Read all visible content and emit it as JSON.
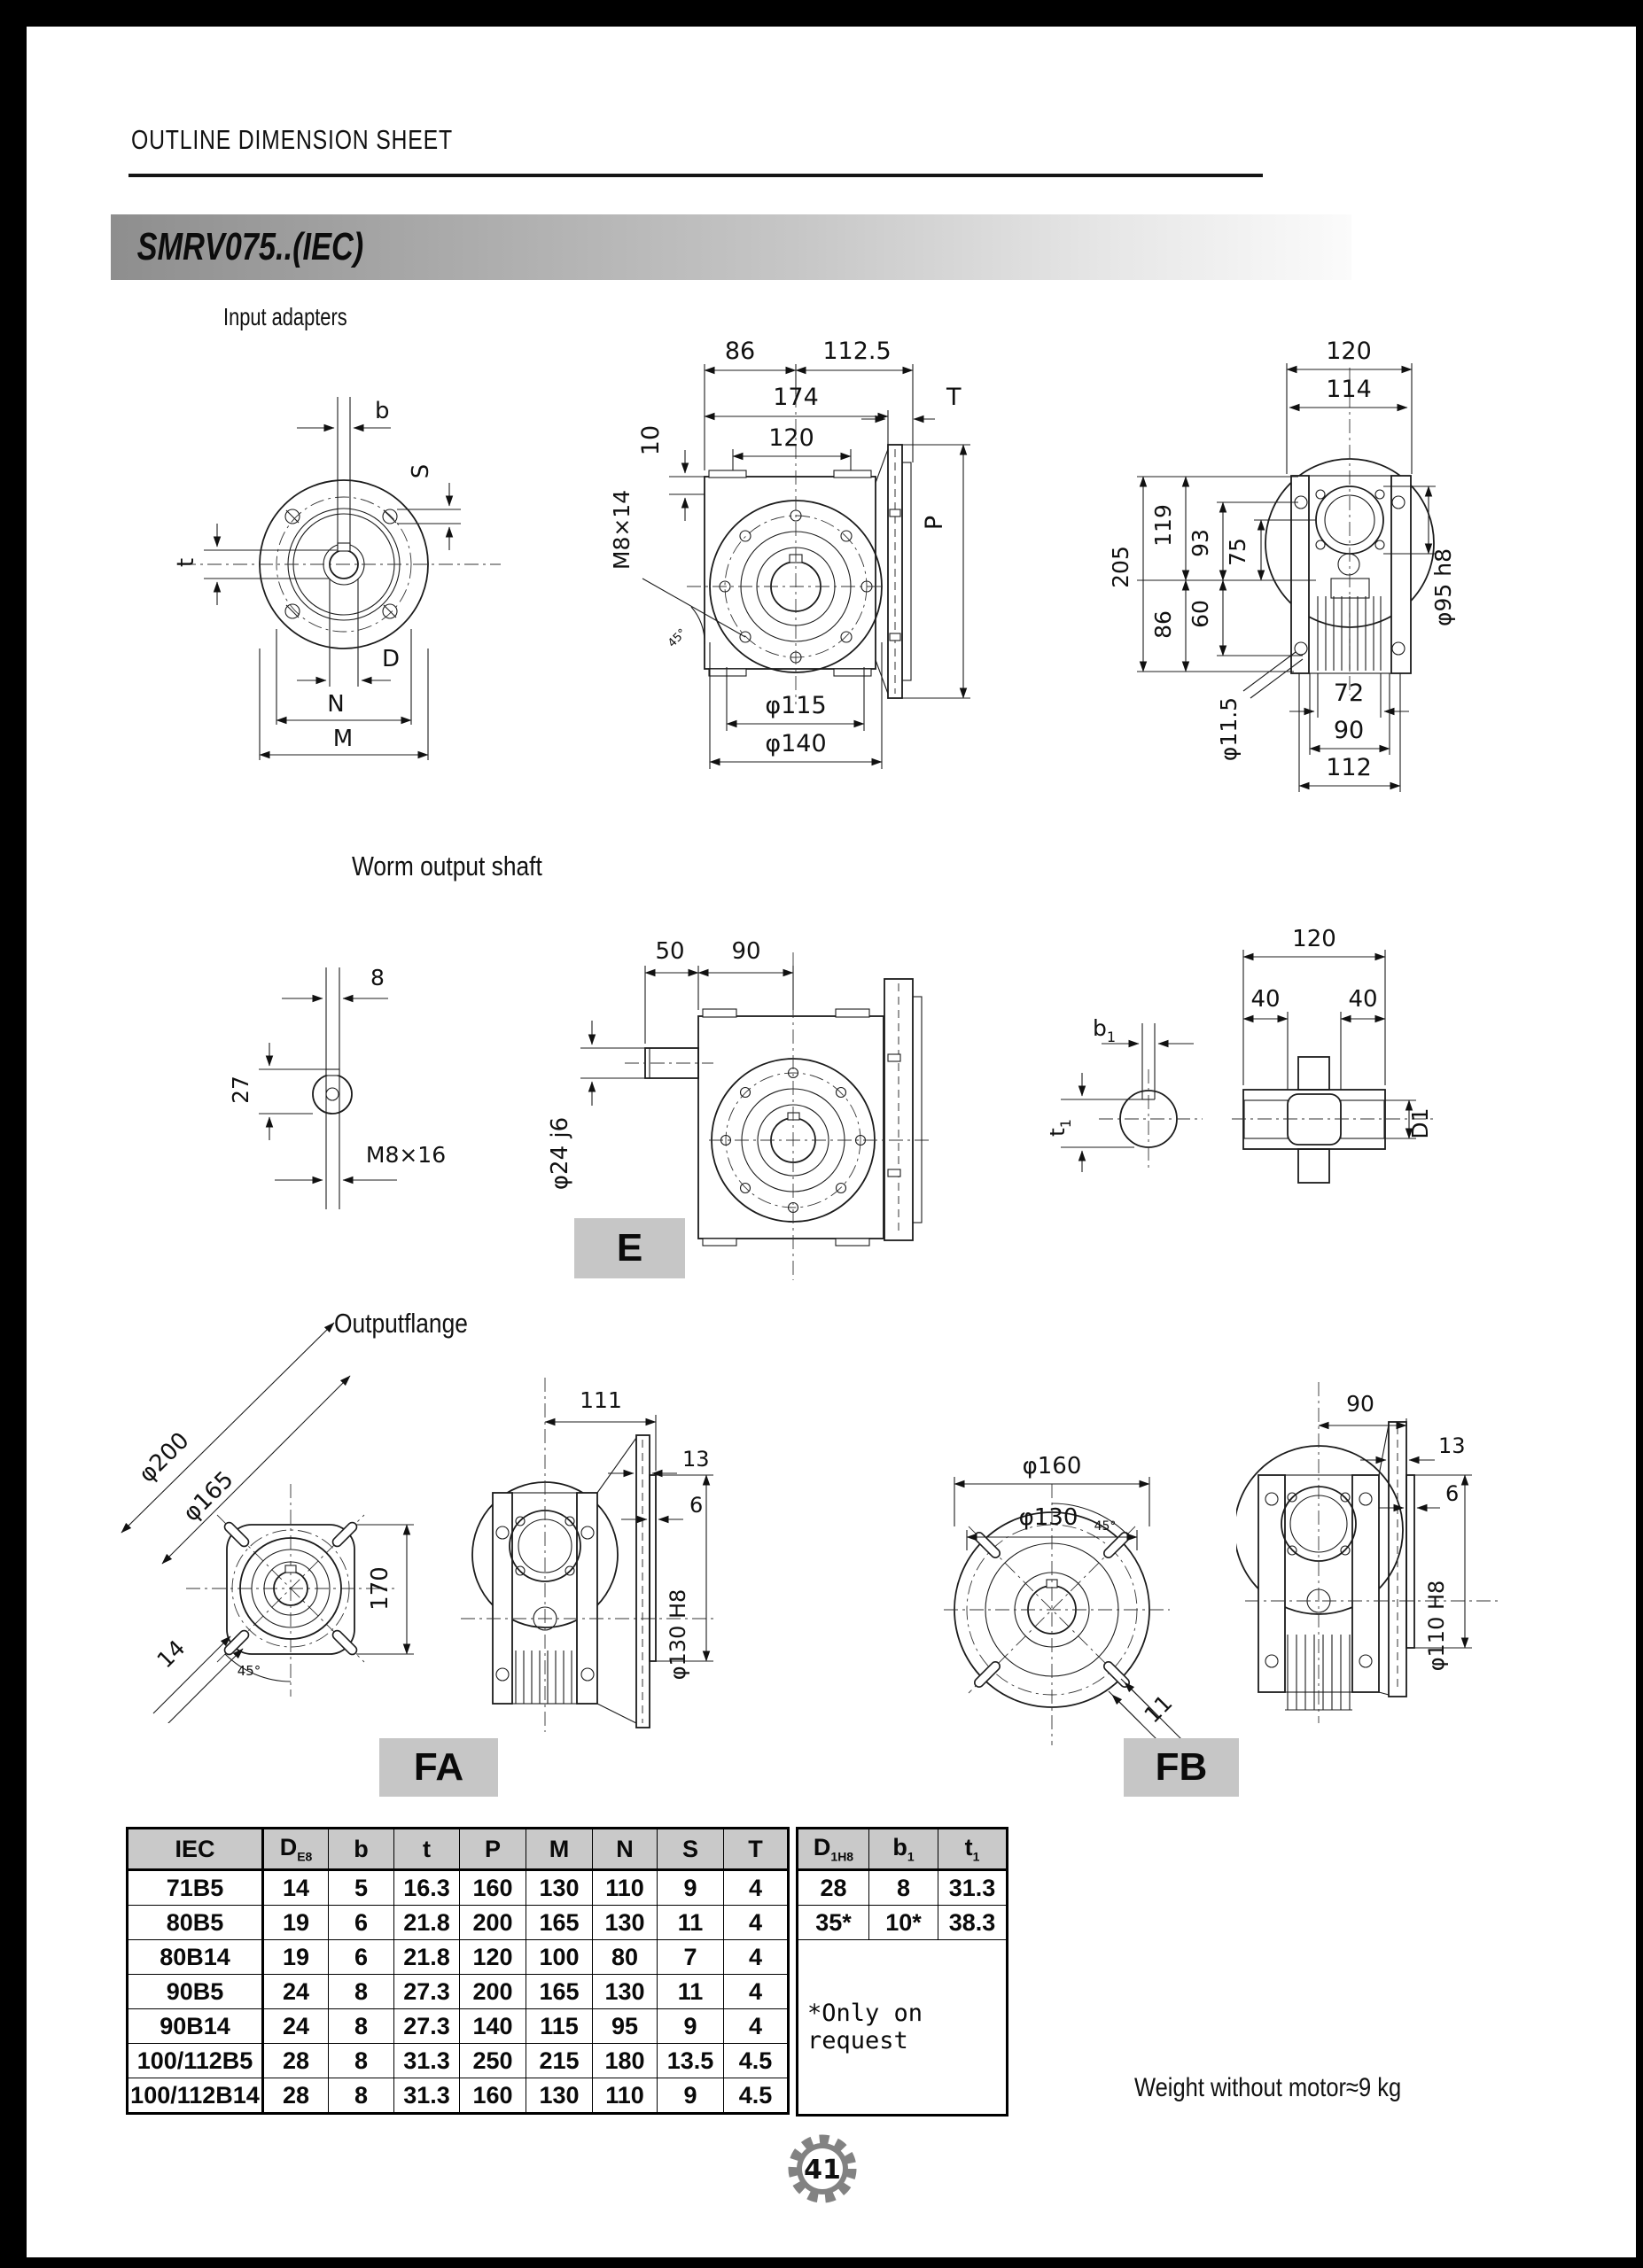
{
  "page": {
    "header_title": "OUTLINE DIMENSION SHEET",
    "model_title": "SMRV075..(IEC)",
    "page_number": "41",
    "weight_note": "Weight without motor≈9 kg"
  },
  "sections": {
    "input_adapters_title": "Input adapters",
    "worm_output_title": "Worm output shaft",
    "output_flange_title": "Outputflange",
    "label_e": "E",
    "label_fa": "FA",
    "label_fb": "FB"
  },
  "drawings": {
    "input_front": {
      "b": "b",
      "s": "S",
      "t": "t",
      "d": "D",
      "n": "N",
      "m": "M"
    },
    "input_side": {
      "d86": "86",
      "d112_5": "112.5",
      "d174": "174",
      "d120": "120",
      "d10": "10",
      "thread": "M8×14",
      "t": "T",
      "p": "P",
      "phi115": "φ115",
      "phi140": "φ140",
      "angle": "45°"
    },
    "input_rear": {
      "d120": "120",
      "d114": "114",
      "d205": "205",
      "d119": "119",
      "d93": "93",
      "d75": "75",
      "d86": "86",
      "d60": "60",
      "phi11_5": "φ11.5",
      "phi95": "φ95 h8",
      "d72": "72",
      "d90": "90",
      "d112": "112"
    },
    "shaft_end": {
      "d8": "8",
      "d27": "27",
      "thread": "M8×16"
    },
    "shaft_side": {
      "d50": "50",
      "d90": "90",
      "phi24": "φ24 j6"
    },
    "hub_end": {
      "b1": "b",
      "b1s": "1",
      "t1": "t",
      "t1s": "1"
    },
    "hub_section": {
      "d120": "120",
      "d40l": "40",
      "d40r": "40",
      "d1": "D1"
    },
    "fa_front": {
      "phi200": "φ200",
      "phi165": "φ165",
      "d170": "170",
      "d14": "14",
      "angle": "45°"
    },
    "fa_side": {
      "d111": "111",
      "d13": "13",
      "d6": "6",
      "phi130": "φ130 H8"
    },
    "fb_front": {
      "phi160": "φ160",
      "phi130": "φ130",
      "d11": "11",
      "angle": "45°"
    },
    "fb_side": {
      "d90": "90",
      "d13": "13",
      "d6": "6",
      "phi110": "φ110 H8"
    }
  },
  "table": {
    "headers": {
      "iec": "IEC",
      "d_base": "D",
      "d_sub": "E8",
      "b": "b",
      "t": "t",
      "p": "P",
      "m": "M",
      "n": "N",
      "s": "S",
      "t2": "T",
      "d1_base": "D",
      "d1_sub": "1H8",
      "b1_base": "b",
      "b1_sub": "1",
      "t1_base": "t",
      "t1_sub": "1"
    },
    "rows": [
      {
        "iec": "71B5",
        "d": "14",
        "b": "5",
        "t": "16.3",
        "p": "160",
        "m": "130",
        "n": "110",
        "s": "9",
        "tt": "4"
      },
      {
        "iec": "80B5",
        "d": "19",
        "b": "6",
        "t": "21.8",
        "p": "200",
        "m": "165",
        "n": "130",
        "s": "11",
        "tt": "4"
      },
      {
        "iec": "80B14",
        "d": "19",
        "b": "6",
        "t": "21.8",
        "p": "120",
        "m": "100",
        "n": "80",
        "s": "7",
        "tt": "4"
      },
      {
        "iec": "90B5",
        "d": "24",
        "b": "8",
        "t": "27.3",
        "p": "200",
        "m": "165",
        "n": "130",
        "s": "11",
        "tt": "4"
      },
      {
        "iec": "90B14",
        "d": "24",
        "b": "8",
        "t": "27.3",
        "p": "140",
        "m": "115",
        "n": "95",
        "s": "9",
        "tt": "4"
      },
      {
        "iec": "100/112B5",
        "d": "28",
        "b": "8",
        "t": "31.3",
        "p": "250",
        "m": "215",
        "n": "180",
        "s": "13.5",
        "tt": "4.5"
      },
      {
        "iec": "100/112B14",
        "d": "28",
        "b": "8",
        "t": "31.3",
        "p": "160",
        "m": "130",
        "n": "110",
        "s": "9",
        "tt": "4.5"
      }
    ],
    "right_rows": [
      {
        "d1": "28",
        "b1": "8",
        "t1": "31.3"
      },
      {
        "d1": "35*",
        "b1": "10*",
        "t1": "38.3"
      }
    ],
    "note": "*Only on request"
  }
}
